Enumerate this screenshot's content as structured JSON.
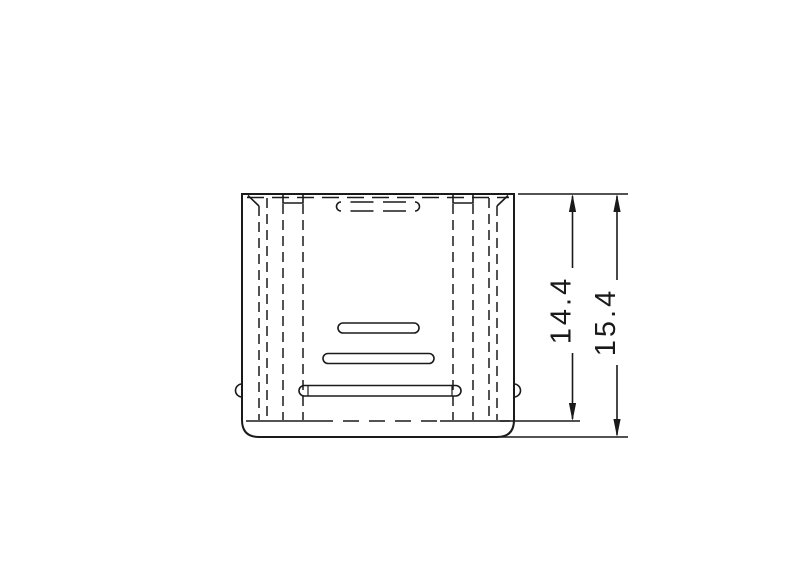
{
  "canvas": {
    "background": "#ffffff",
    "line_color": "#1a1a1a"
  },
  "drawing": {
    "type": "technical-drawing-side-view",
    "line_styles": [
      "solid-visible-edges",
      "dashed-hidden-edges"
    ]
  },
  "dimensions": [
    {
      "id": "inner-depth",
      "value": "14.4"
    },
    {
      "id": "overall-height",
      "value": "15.4"
    }
  ]
}
